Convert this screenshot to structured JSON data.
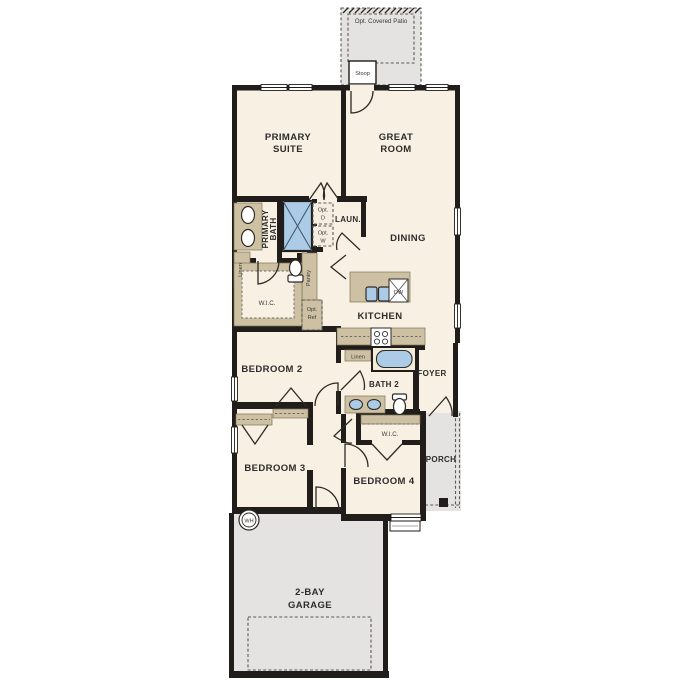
{
  "plan": {
    "name": "single-story-floor-plan",
    "colors": {
      "wall": "#201d1a",
      "floor": "#f8f0e2",
      "exterior_concrete": "#e4e3e1",
      "cabinet_tan": "#cec1a3",
      "fixture_blue": "#abcbe6",
      "label_text": "#2c2c2c"
    },
    "exterior": {
      "patio_label": "Opt. Covered Patio",
      "stoop_label": "Stoop",
      "porch_label": "PORCH",
      "garage_line1": "2-BAY",
      "garage_line2": "GARAGE"
    },
    "rooms": {
      "primary_suite": {
        "line1": "PRIMARY",
        "line2": "SUITE"
      },
      "great_room": {
        "line1": "GREAT",
        "line2": "ROOM"
      },
      "primary_bath": {
        "line1": "PRIMARY",
        "line2": "BATH"
      },
      "laundry": {
        "label": "LAUN."
      },
      "dining": {
        "label": "DINING"
      },
      "kitchen": {
        "label": "KITCHEN"
      },
      "wic_primary": {
        "label": "W.I.C."
      },
      "bedroom2": {
        "label": "BEDROOM 2"
      },
      "bath2": {
        "label": "BATH 2"
      },
      "foyer": {
        "label": "FOYER"
      },
      "bedroom3": {
        "label": "BEDROOM 3"
      },
      "bedroom4": {
        "label": "BEDROOM 4"
      },
      "wic_bedroom4": {
        "label": "W.I.C."
      }
    },
    "fixtures": {
      "opt_dryer_line1": "Opt.",
      "opt_dryer_line2": "D",
      "opt_washer_line1": "Opt.",
      "opt_washer_line2": "W",
      "linen_primary": "Linen",
      "pantry": "Pantry",
      "opt_ref_line1": "Opt.",
      "opt_ref_line2": "Ref",
      "dishwasher": "DW",
      "linen_bath2": "Linen",
      "water_heater": "WH"
    }
  }
}
